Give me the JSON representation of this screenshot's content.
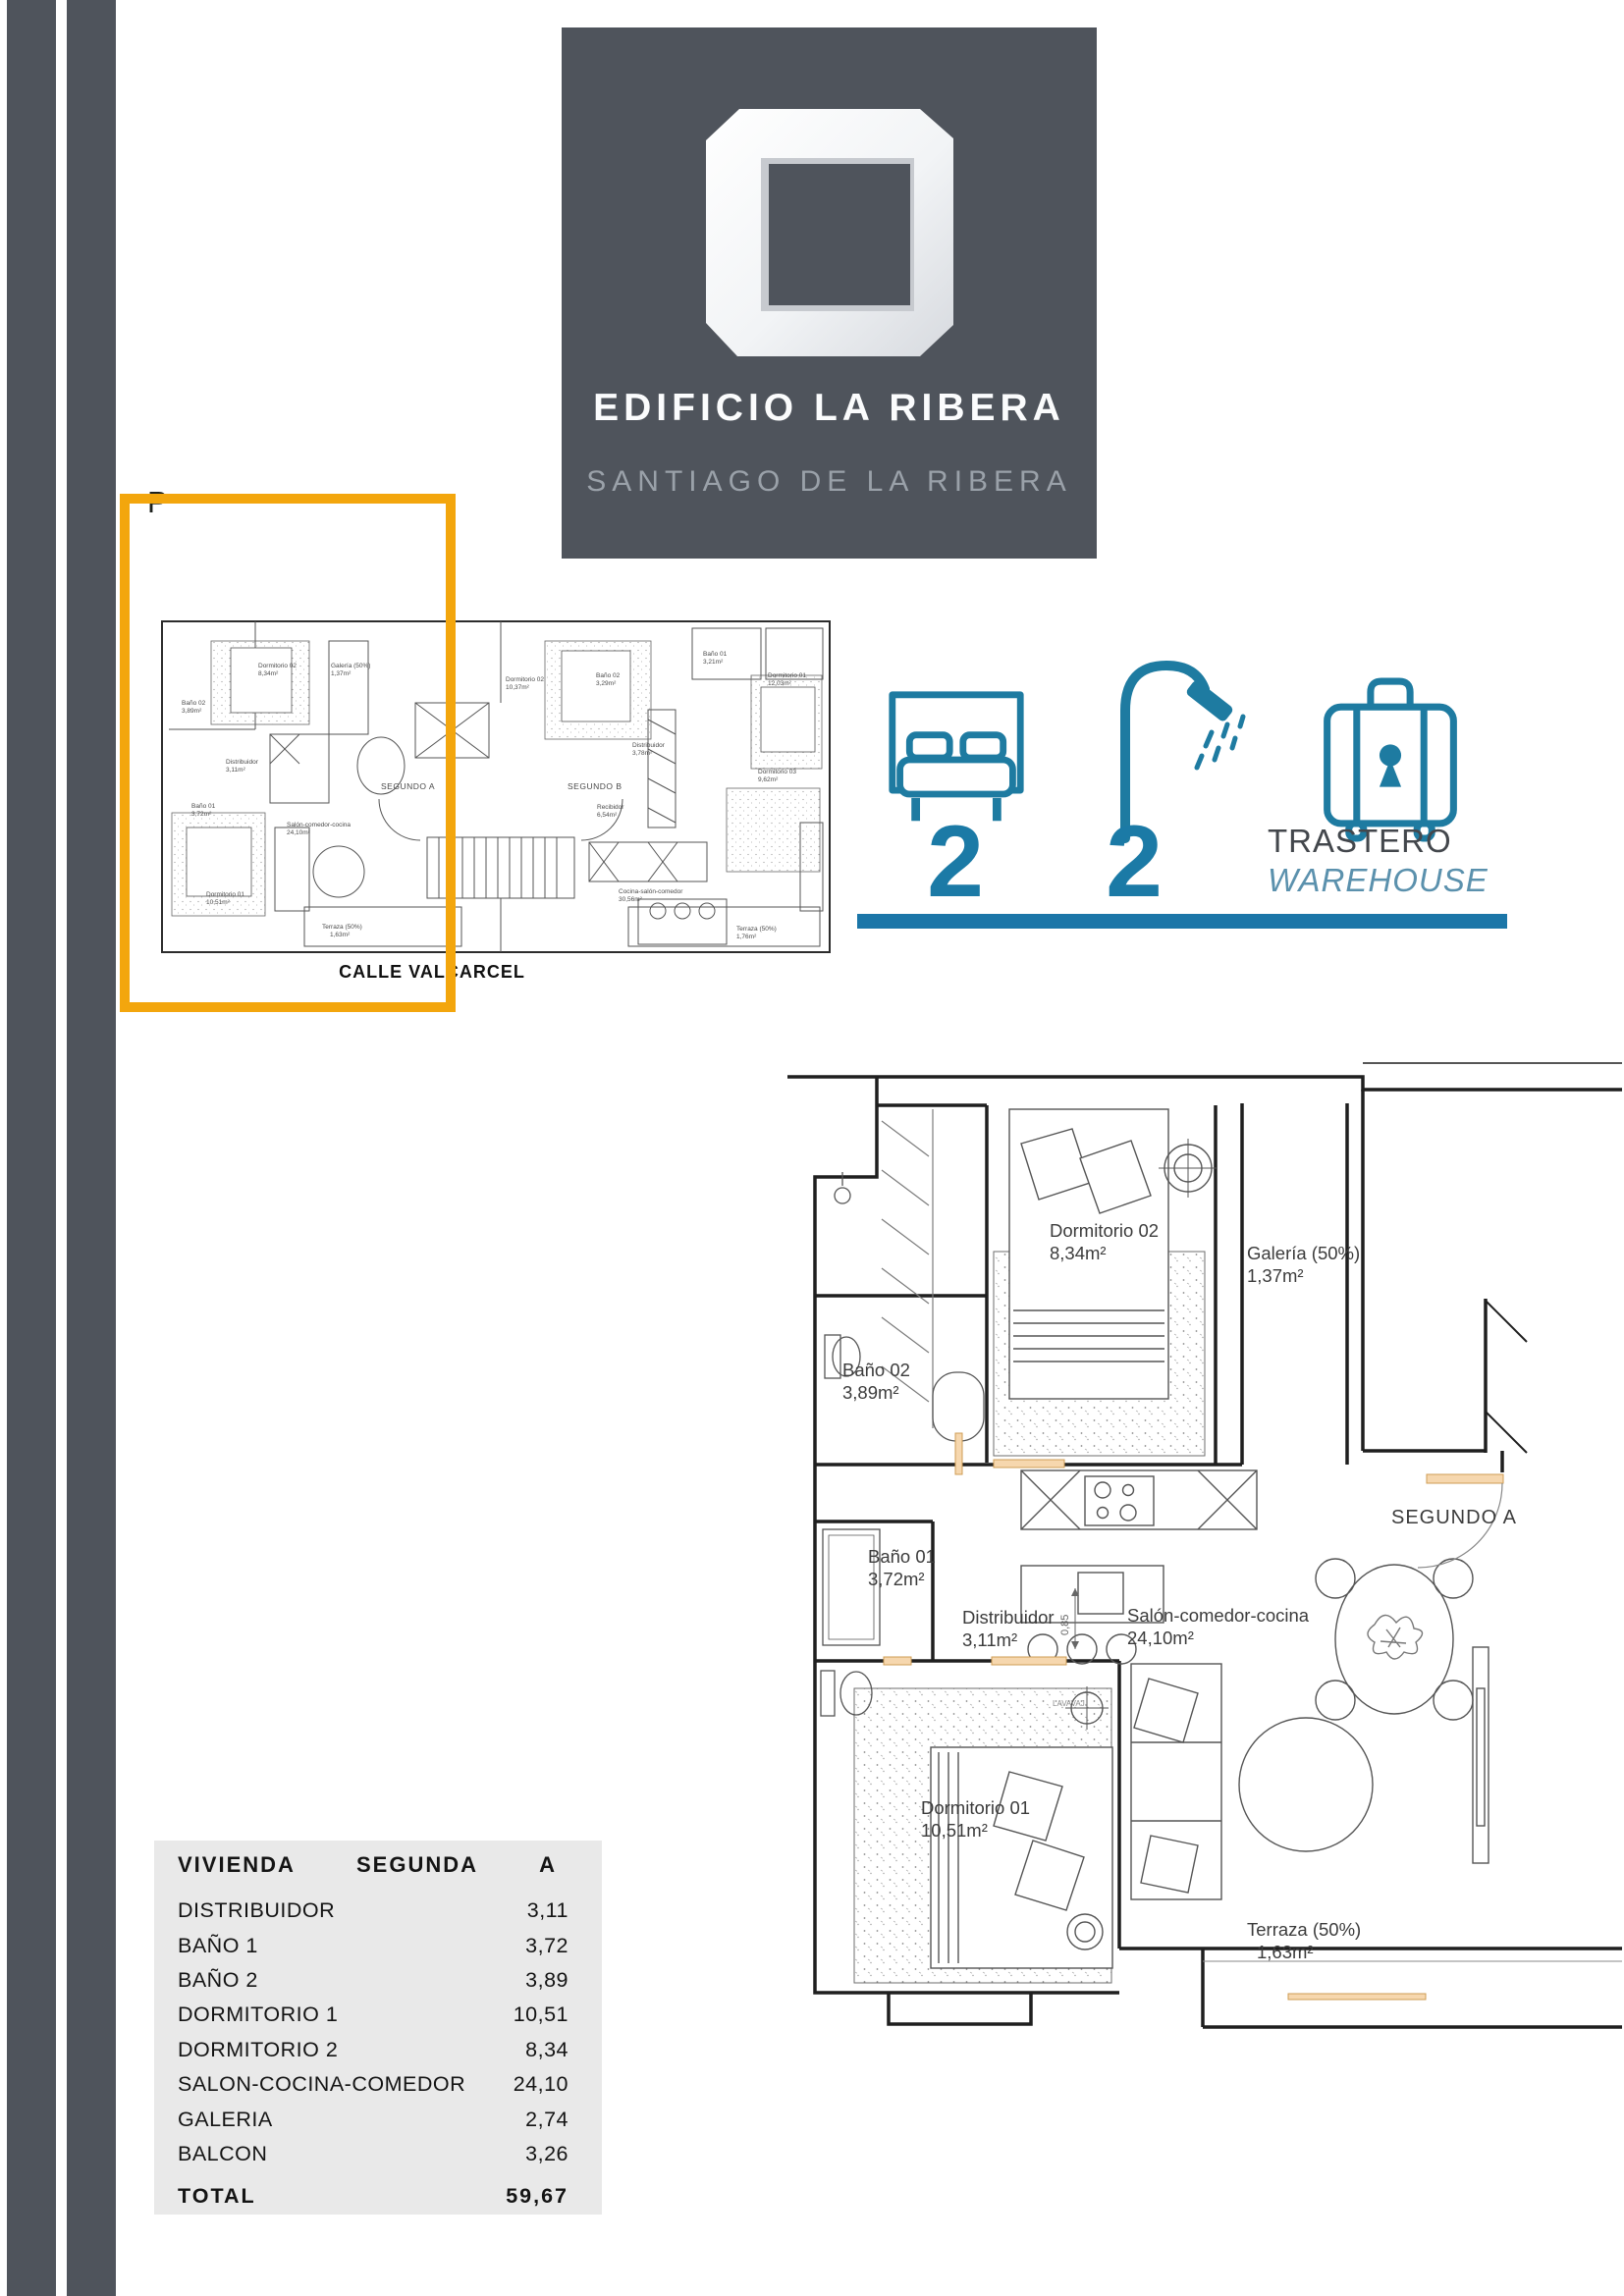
{
  "page": {
    "letter": "P"
  },
  "header": {
    "title": "EDIFICIO LA RIBERA",
    "subtitle": "SANTIAGO DE LA RIBERA",
    "logo": "open-cube-logo",
    "background_color": "#4F545C"
  },
  "overview_plan": {
    "street_label": "CALLE VALCARCEL",
    "unit_a_label": "SEGUNDO A",
    "unit_b_label": "SEGUNDO B",
    "highlight_color": "#F3A60D",
    "unit_b_rooms": [
      {
        "name": "Dormitorio 02",
        "area": "10,37m²"
      },
      {
        "name": "Baño 02",
        "area": "3,29m²"
      },
      {
        "name": "Baño 01",
        "area": "3,21m²"
      },
      {
        "name": "Dormitorio 01",
        "area": "12,03m²"
      },
      {
        "name": "Distribuidor",
        "area": "3,78m²"
      },
      {
        "name": "Dormitorio 03",
        "area": "9,62m²"
      },
      {
        "name": "Recibidor",
        "area": "6,54m²"
      },
      {
        "name": "Cocina-salón-comedor",
        "area": "30,56m²"
      },
      {
        "name": "Terraza (50%)",
        "area": "1,76m²"
      }
    ]
  },
  "features": {
    "accent_color": "#1B7AA6",
    "bedrooms": {
      "icon": "bed-icon",
      "count": "2"
    },
    "bathrooms": {
      "icon": "shower-icon",
      "count": "2"
    },
    "storage": {
      "icon": "suitcase-icon",
      "label_es": "TRASTERO",
      "label_en": "WAREHOUSE"
    }
  },
  "floor_plan": {
    "unit_label": "SEGUNDO A",
    "dimension_label": "0,85",
    "appliance_label": "LAVAVAJ.",
    "rooms": [
      {
        "name": "Dormitorio 02",
        "area": "8,34m²"
      },
      {
        "name": "Galería (50%)",
        "area": "1,37m²"
      },
      {
        "name": "Baño 02",
        "area": "3,89m²"
      },
      {
        "name": "Distribuidor",
        "area": "3,11m²"
      },
      {
        "name": "Baño 01",
        "area": "3,72m²"
      },
      {
        "name": "Salón-comedor-cocina",
        "area": "24,10m²"
      },
      {
        "name": "Dormitorio 01",
        "area": "10,51m²"
      },
      {
        "name": "Terraza (50%)",
        "area": "1,63m²"
      }
    ]
  },
  "summary_table": {
    "header": {
      "col1": "VIVIENDA",
      "col2": "SEGUNDA",
      "col3": "A"
    },
    "rows": [
      {
        "label": "DISTRIBUIDOR",
        "value": "3,11"
      },
      {
        "label": "BAÑO 1",
        "value": "3,72"
      },
      {
        "label": "BAÑO 2",
        "value": "3,89"
      },
      {
        "label": "DORMITORIO 1",
        "value": "10,51"
      },
      {
        "label": "DORMITORIO 2",
        "value": "8,34"
      },
      {
        "label": "SALON-COCINA-COMEDOR",
        "value": "24,10"
      },
      {
        "label": "GALERIA",
        "value": "2,74"
      },
      {
        "label": "BALCON",
        "value": "3,26"
      }
    ],
    "total": {
      "label": "TOTAL",
      "value": "59,67"
    }
  }
}
